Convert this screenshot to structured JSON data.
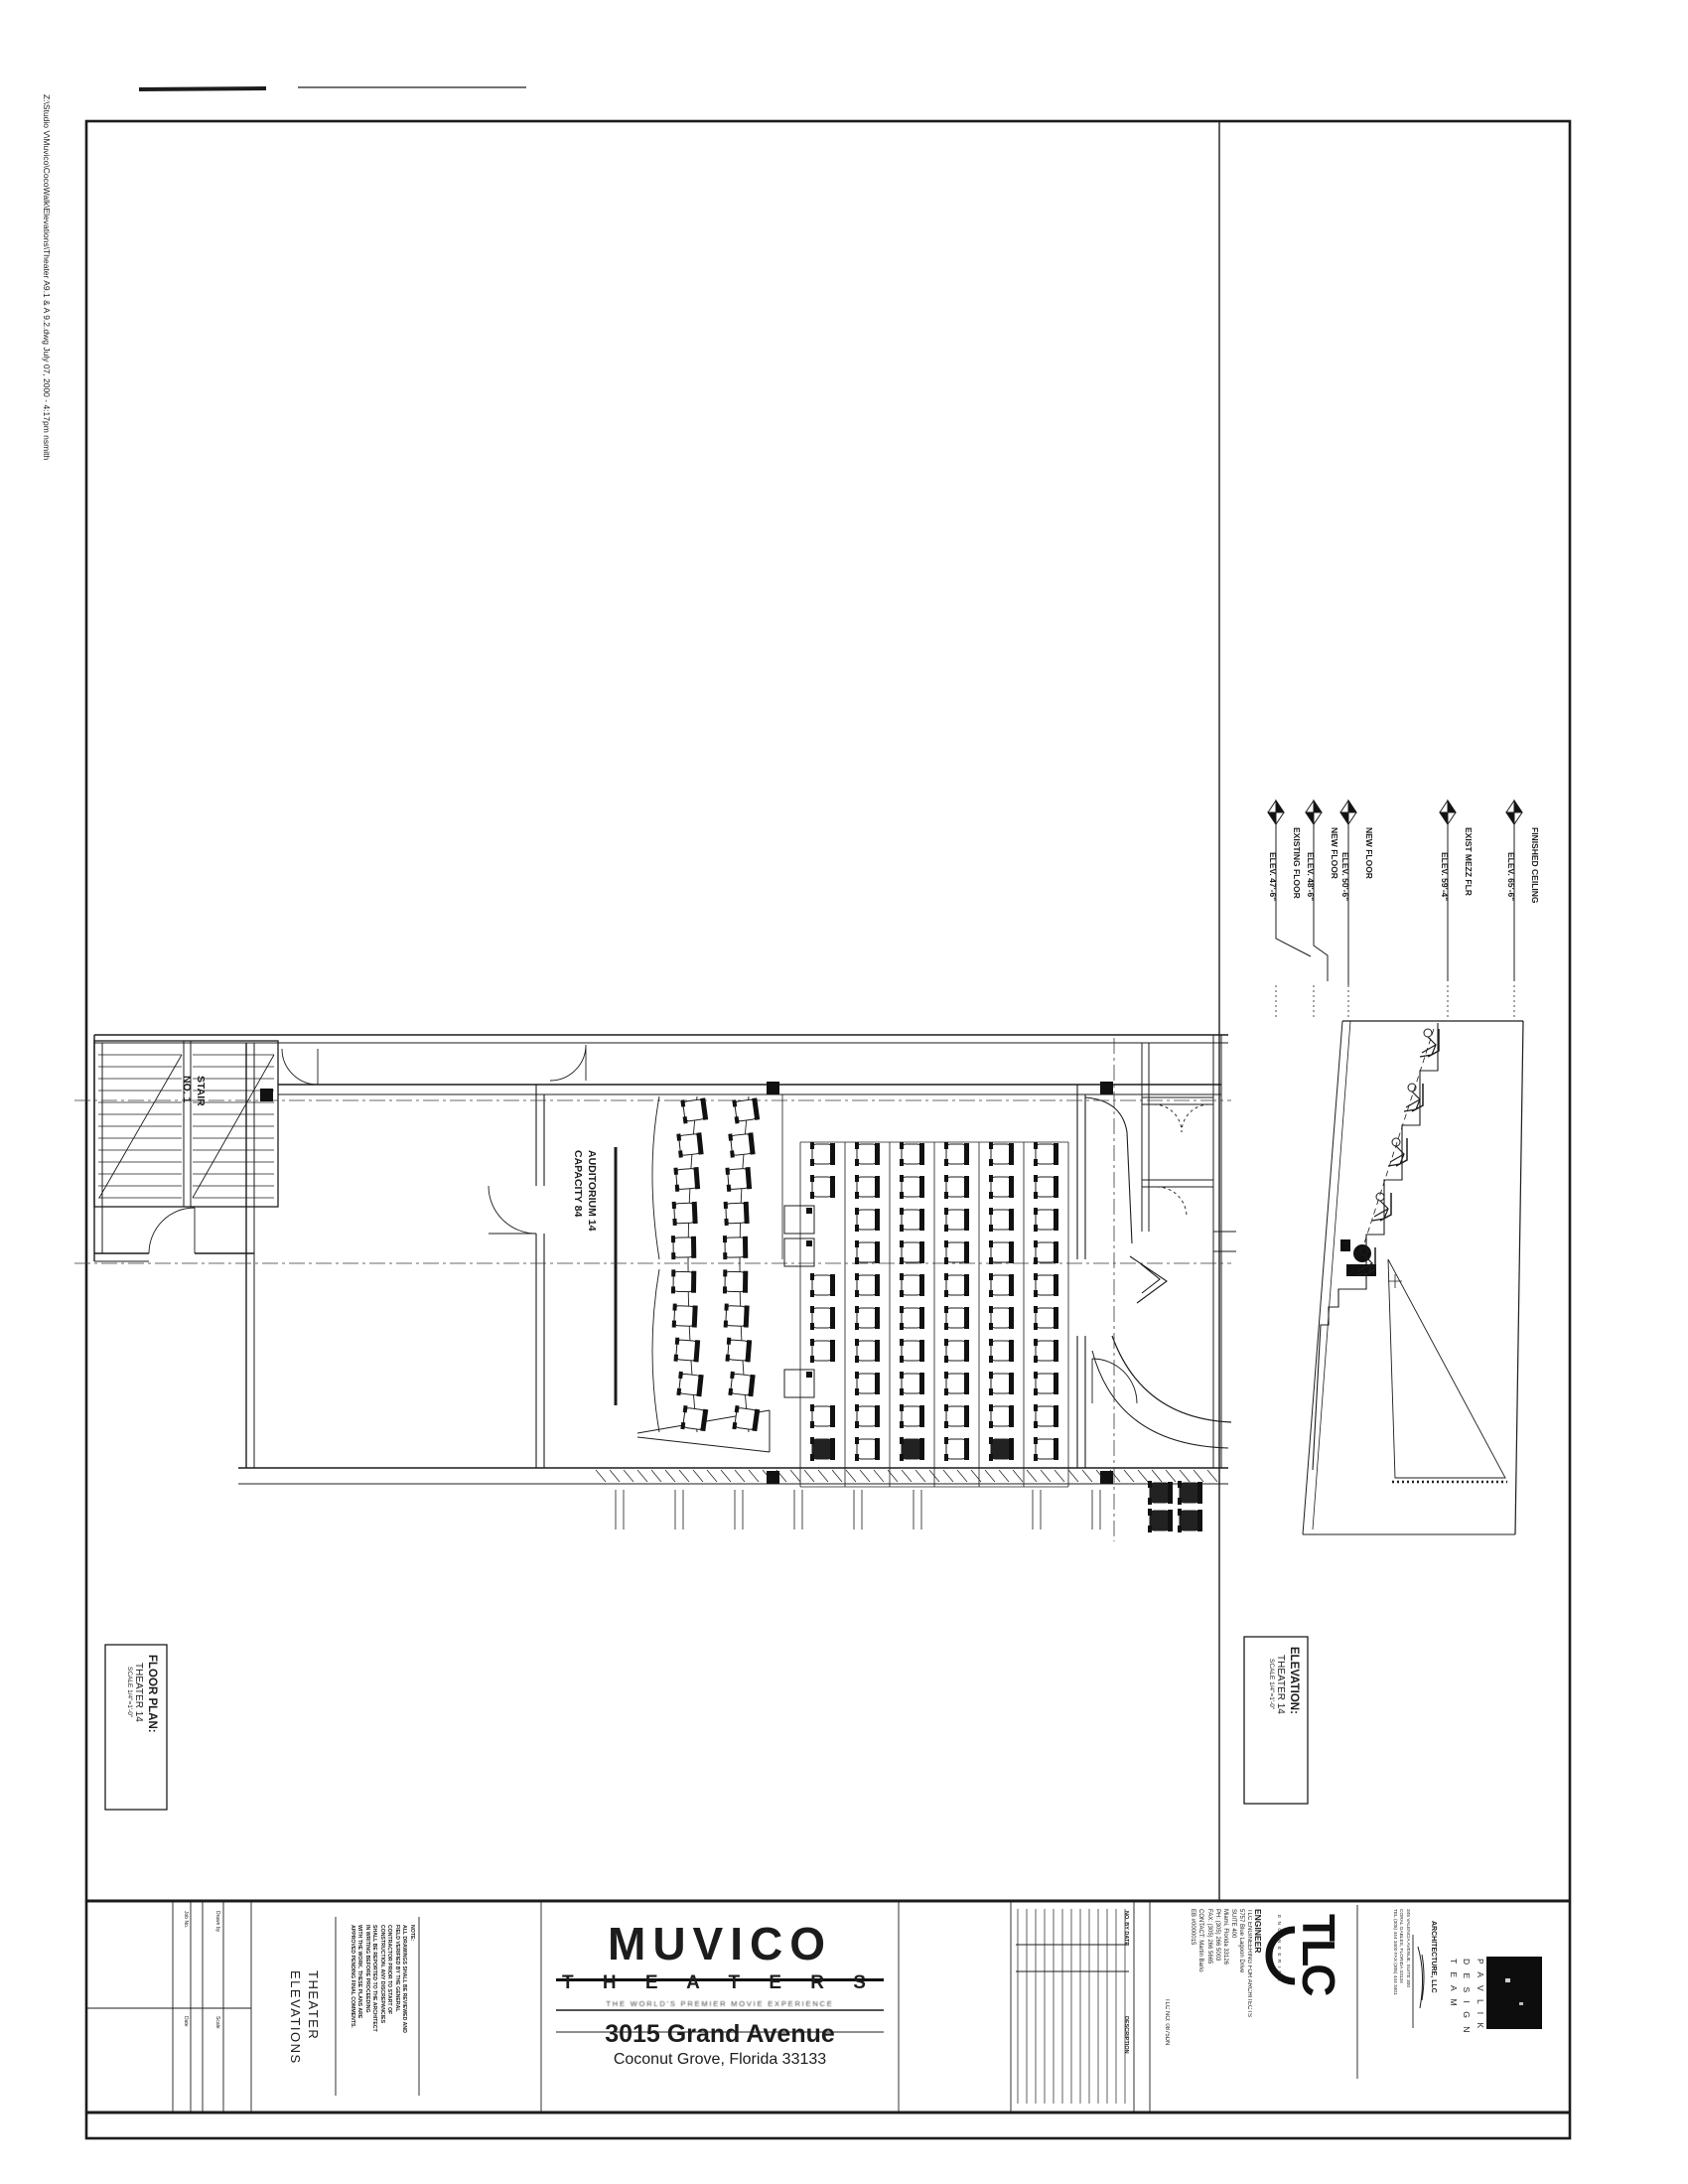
{
  "colors": {
    "ink": "#1c1c1c",
    "paper": "#ffffff"
  },
  "page": {
    "file_note": "Z:\\Studio V\\Muvico\\CocoWalk\\Elevations\\Theater A9.1 & A 9.2.dwg      July 07, 2000 - 4:17pm   nsmith"
  },
  "floor_plan": {
    "label": {
      "title": "FLOOR PLAN:",
      "subtitle": "THEATER 14",
      "scale": "SCALE 1/4\"=1'-0\""
    },
    "stair_label": "STAIR\nNO. 1",
    "auditorium_label": "AUDITORIUM 14\nCAPACITY 84",
    "seating": {
      "curved_rows": 2,
      "curved_seats_per_row": 10,
      "stadium_rows": 6,
      "stadium_seats_per_row": 10,
      "wheelchair_spaces": 3,
      "capacity": 84
    }
  },
  "elevation": {
    "label": {
      "title": "ELEVATION:",
      "subtitle": "THEATER 14",
      "scale": "SCALE 1/4\"=1'-0\""
    },
    "datums": [
      {
        "name": "FINISHED CEILING",
        "elev": "ELEV.  65'-6\""
      },
      {
        "name": "EXIST MEZZ FLR",
        "elev": "ELEV.  59'-4\""
      },
      {
        "name": "NEW FLOOR",
        "elev": "ELEV.  50'-6\""
      },
      {
        "name": "NEW FLOOR",
        "elev": "ELEV.  48'-6\""
      },
      {
        "name": "EXISTING FLOOR",
        "elev": "ELEV.  47'-6\""
      }
    ],
    "section_seat_count": 5
  },
  "title_block": {
    "sheet_title": "THEATER\nELEVATIONS",
    "note": "NOTE:\nALL DRAWINGS SHALL BE REVIEWED AND\nFIELD VERIFIED BY THE GENERAL\nCONTRACTOR PRIOR TO START OF\nCONSTRUCTION. ANY DISCREPANCIES\nSHALL BE REPORTED TO THE ARCHITECT\nIN WRITING BEFORE PROCEEDING\nWITH THE WORK. THESE PLANS ARE\nAPPROVED PENDING FINAL COMMENTS.",
    "fields": [
      "Job No.",
      "Drawn by",
      "Date",
      "Scale"
    ],
    "brand": {
      "name": "MUVICO",
      "word2": "T H E A T E R S",
      "tagline": "THE WORLD'S PREMIER MOVIE EXPERIENCE",
      "address1": "3015 Grand Avenue",
      "address2": "Coconut Grove, Florida 33133"
    },
    "revisions": {
      "col1": "NO.  BY  DATE",
      "col2": "DESCRIPTION"
    },
    "tlc_no": "TLC NO: 0875DN",
    "engineer": {
      "heading": "ENGINEER",
      "lines": "TLC ENGINEERING FOR ARCHITECTS\n5757 Blue Lagoon Drive\nSUITE 400\nMiami, Florida 33126\nPH: (305) 266 5003\nFAX: (305) 266 5665\nCONTACT: Martin Bario\nEB #0000015",
      "logo": "TLC",
      "logo_side": "E N G I N E E R I N G"
    },
    "architect": {
      "team": "P A V L I K\nD E S I G N\nT E A M",
      "firm": "ARCHITECTURE, LLC",
      "address": "345 VALENCIA AVENUE, SUITE 300\nCORAL GABLES, FLORIDA 33134\nTEL (305) 444 3400   FAX (305) 444 3401"
    }
  }
}
